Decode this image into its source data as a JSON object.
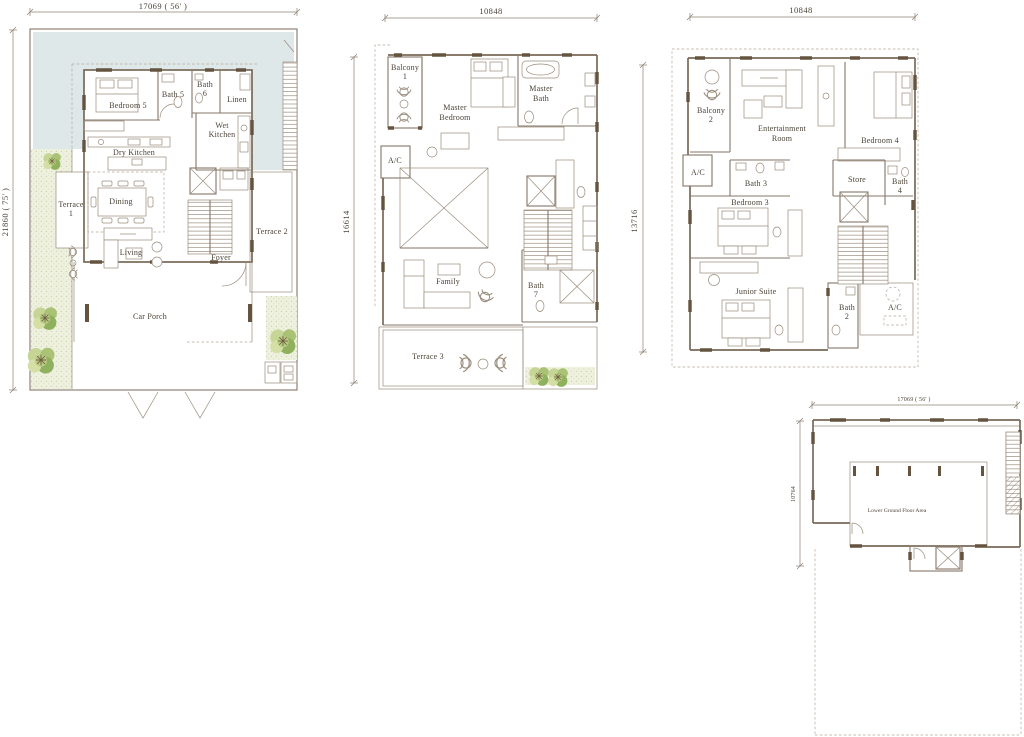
{
  "palette": {
    "paper": "#ffffff",
    "line": "#9a8c7c",
    "wall": "#796957",
    "wall_fill_dark": "#64533f",
    "text": "#4a4236",
    "water_deck": "#dfe8e9",
    "lawn": "#eef1de",
    "lawn_dot": "#c9cfae",
    "tree_light": "#d4dfa6",
    "tree_mid": "#aac276",
    "tree_dark": "#8fb05c",
    "branch": "#6f5f42",
    "dashed_line": "#b1a795"
  },
  "plans": [
    {
      "name": "ground-floor",
      "dim_top": "17069 ( 56' )",
      "dim_side": "21860 ( 75' )",
      "rooms": {
        "bedroom5": "Bedroom 5",
        "bath5": "Bath 5",
        "bath6": [
          "Bath",
          "6"
        ],
        "linen": "Linen",
        "wet_kitchen": [
          "Wet",
          "Kitchen"
        ],
        "dry_kitchen": "Dry Kitchen",
        "dining": "Dining",
        "terrace1": [
          "Terrace",
          "1"
        ],
        "living": "Living",
        "foyer": "Foyer",
        "terrace2": "Terrace 2",
        "car_porch": "Car Porch"
      }
    },
    {
      "name": "first-floor",
      "dim_top": "10848",
      "dim_side": "16614",
      "dim_right": "13716",
      "rooms": {
        "balcony1": [
          "Balcony",
          "1"
        ],
        "master_bedroom": [
          "Master",
          "Bedroom"
        ],
        "master_bath": [
          "Master",
          "Bath"
        ],
        "ac": "A/C",
        "family": "Family",
        "bath7": [
          "Bath",
          "7"
        ],
        "terrace3": "Terrace 3"
      }
    },
    {
      "name": "second-floor",
      "dim_top": "10848",
      "rooms": {
        "balcony2": [
          "Balcony",
          "2"
        ],
        "entertainment": [
          "Entertainment",
          "Room"
        ],
        "bedroom4": "Bedroom 4",
        "ac1": "A/C",
        "bath3": "Bath 3",
        "store": "Store",
        "bath4": [
          "Bath",
          "4"
        ],
        "bedroom3": "Bedroom 3",
        "junior_suite": "Junior Suite",
        "bath2": [
          "Bath",
          "2"
        ],
        "ac2": "A/C"
      }
    },
    {
      "name": "lower-ground-floor",
      "dim_top": "17069 ( 56' )",
      "dim_side": "10764",
      "rooms": {
        "lower_ground": "Lower Ground Floor Area"
      }
    }
  ]
}
